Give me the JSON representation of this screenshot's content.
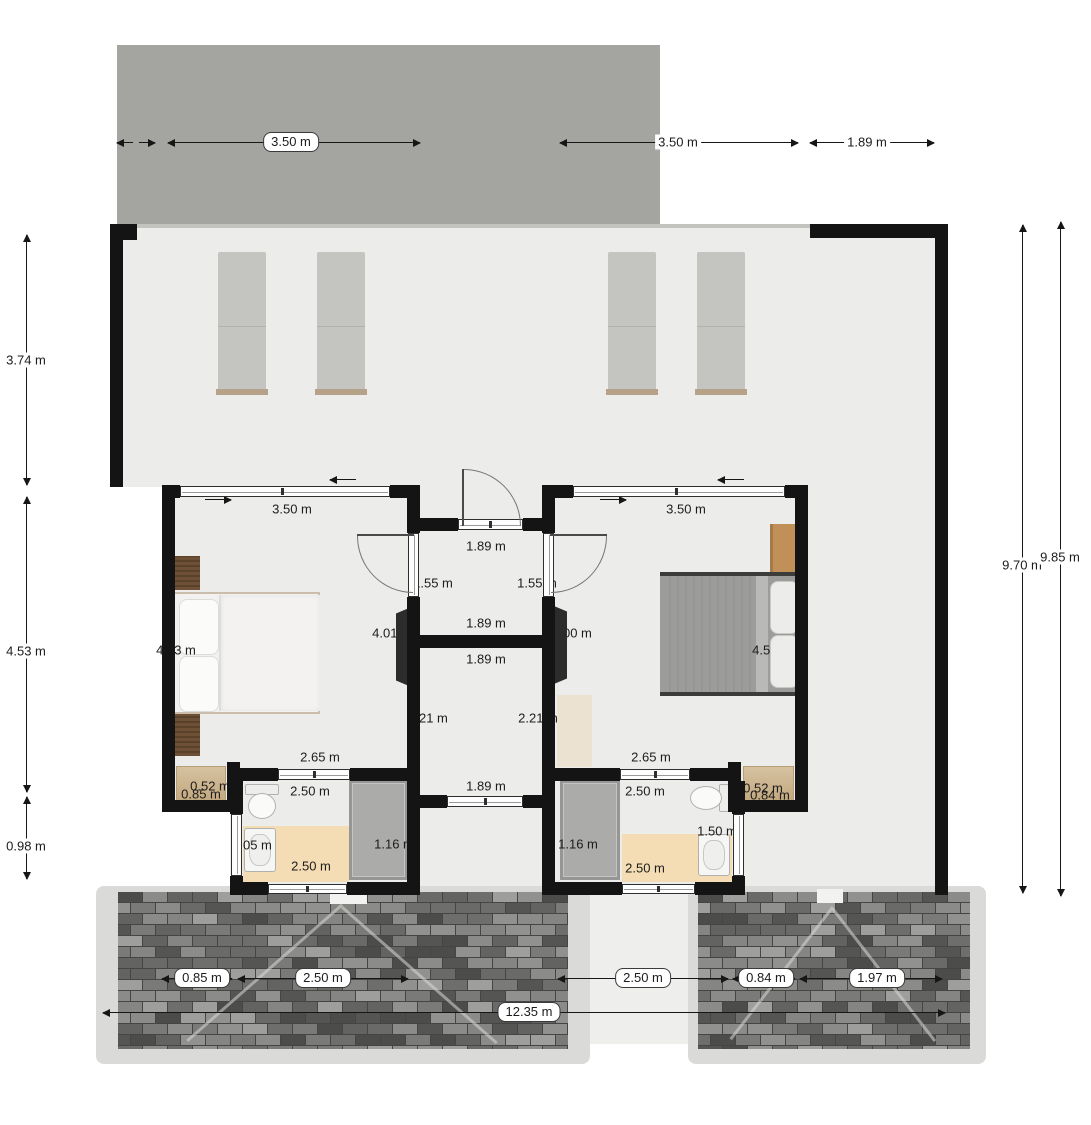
{
  "plan": {
    "roof": {
      "span_left": "3.50 m",
      "span_right": "3.50 m",
      "side": "1.89 m"
    },
    "left_edge": {
      "terrace": "3.74 m",
      "rooms": "4.53 m",
      "bath": "0.98 m"
    },
    "right_edge": {
      "inner": "9.70 m",
      "outer": "9.85 m"
    },
    "bedroom_left": {
      "width": "3.50 m",
      "depth": "4.53 m",
      "door": "1.55 m",
      "tv_wall": "4.01 m",
      "closet": "2.65 m",
      "dresser_depth": "0.52 m",
      "dresser_width": "0.85 m"
    },
    "bedroom_right": {
      "width": "3.50 m",
      "depth": "4.52 m",
      "door": "1.55 m",
      "tv_wall": "4.00 m",
      "closet": "2.65 m",
      "dresser_depth": "0.52 m",
      "dresser_width": "0.84 m"
    },
    "hall": {
      "entry": "1.89 m",
      "width": "1.89 m",
      "store_top": "1.89 m",
      "store_left": "2.21 m",
      "store_right": "2.21 m",
      "store_bottom": "1.89 m"
    },
    "bath_left": {
      "width_top": "2.50 m",
      "width_bottom": "2.50 m",
      "side": "1.05 m",
      "shower": "1.16 m"
    },
    "bath_right": {
      "width_top": "2.50 m",
      "width_bottom": "2.50 m",
      "side": "1.50 m",
      "shower": "1.16 m"
    },
    "patio": {
      "left_step": "0.85 m",
      "left_span": "2.50 m",
      "total": "12.35 m",
      "gap": "2.50 m",
      "right_step": "0.84 m",
      "right_span": "1.97 m"
    }
  },
  "colors": {
    "wall": "#141414",
    "roof": "#a4a4a1",
    "floor": "#ecedea",
    "bath_mat": "#f4ddb4",
    "shower": "#ababa9",
    "patio_border": "#dadad8",
    "brick_base": "#454543"
  }
}
